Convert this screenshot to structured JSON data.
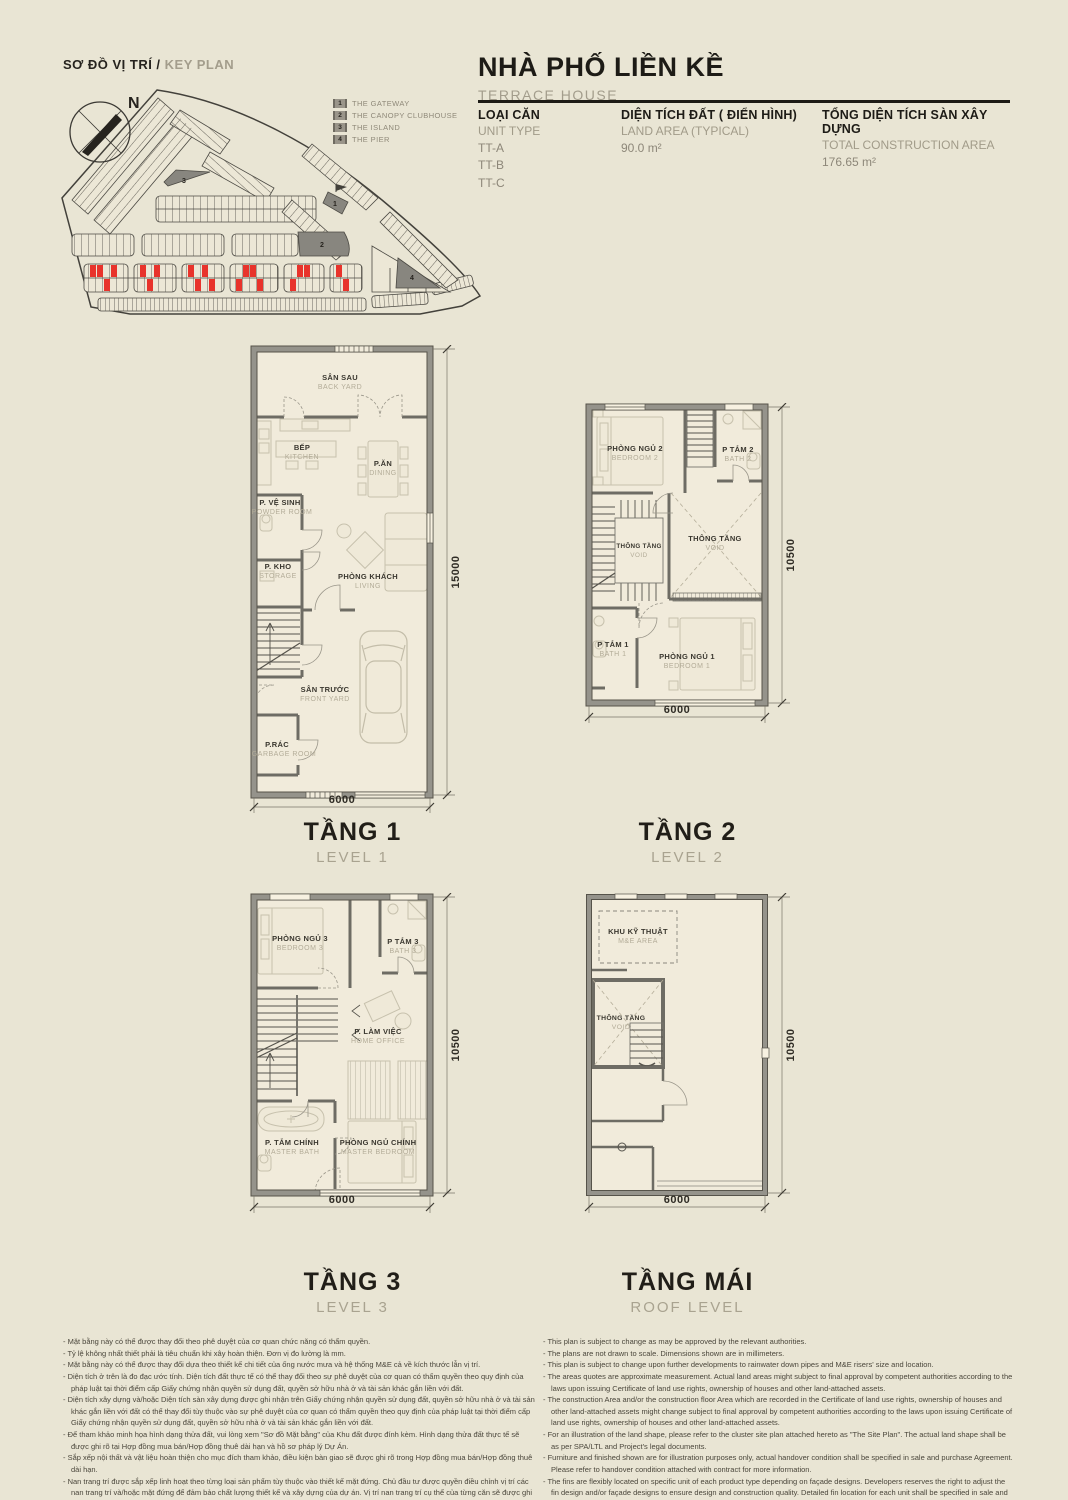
{
  "key_plan": {
    "title_vn": "SƠ ĐỒ VỊ TRÍ /",
    "title_en": " KEY PLAN",
    "north_label": "N",
    "legend": [
      {
        "num": "1",
        "label": "THE GATEWAY"
      },
      {
        "num": "2",
        "label": "THE CANOPY CLUBHOUSE"
      },
      {
        "num": "3",
        "label": "THE ISLAND"
      },
      {
        "num": "4",
        "label": "THE PIER"
      }
    ]
  },
  "header": {
    "title_vn": "NHÀ PHỐ LIỀN KỀ",
    "title_en": "TERRACE HOUSE",
    "unit_type": {
      "label_vn": "LOẠI CĂN",
      "label_en": "UNIT TYPE",
      "values": [
        "TT-A",
        "TT-B",
        "TT-C"
      ]
    },
    "land_area": {
      "label_vn": "DIỆN TÍCH ĐẤT ( ĐIỂN HÌNH)",
      "label_en": "LAND AREA (TYPICAL)",
      "value": "90.0 m²"
    },
    "construction_area": {
      "label_vn": "TỔNG DIỆN TÍCH SÀN XÂY DỰNG",
      "label_en": "TOTAL CONSTRUCTION AREA",
      "value": "176.65 m²"
    }
  },
  "plans": {
    "level1": {
      "title_vn": "TẦNG 1",
      "title_en": "LEVEL 1",
      "dim_width": "6000",
      "dim_height": "15000",
      "rooms": {
        "backyard_vn": "SÂN SAU",
        "backyard_en": "BACK YARD",
        "kitchen_vn": "BẾP",
        "kitchen_en": "KITCHEN",
        "dining_vn": "P.ĂN",
        "dining_en": "DINING",
        "powder_vn": "P. VỆ SINH",
        "powder_en": "POWDER ROOM",
        "storage_vn": "P. KHO",
        "storage_en": "STORAGE",
        "living_vn": "PHÒNG KHÁCH",
        "living_en": "LIVING",
        "frontyard_vn": "SÂN TRƯỚC",
        "frontyard_en": "FRONT YARD",
        "garbage_vn": "P.RÁC",
        "garbage_en": "GARBAGE ROOM"
      }
    },
    "level2": {
      "title_vn": "TẦNG 2",
      "title_en": "LEVEL 2",
      "dim_width": "6000",
      "dim_height": "10500",
      "rooms": {
        "bedroom2_vn": "PHÒNG NGỦ 2",
        "bedroom2_en": "BEDROOM 2",
        "bath2_vn": "P TẮM 2",
        "bath2_en": "BATH 2",
        "voidstair_vn": "THÔNG TẦNG",
        "voidstair_en": "VOID",
        "void_vn": "THÔNG TẦNG",
        "void_en": "VOID",
        "bath1_vn": "P TẮM 1",
        "bath1_en": "BATH 1",
        "bedroom1_vn": "PHÒNG NGỦ 1",
        "bedroom1_en": "BEDROOM 1"
      }
    },
    "level3": {
      "title_vn": "TẦNG 3",
      "title_en": "LEVEL 3",
      "dim_width": "6000",
      "dim_height": "10500",
      "rooms": {
        "bedroom3_vn": "PHÒNG NGỦ 3",
        "bedroom3_en": "BEDROOM 3",
        "bath3_vn": "P TẮM 3",
        "bath3_en": "BATH 3",
        "office_vn": "P. LÀM VIỆC",
        "office_en": "HOME OFFICE",
        "masterbath_vn": "P. TẮM CHÍNH",
        "masterbath_en": "MASTER BATH",
        "masterbed_vn": "PHÒNG NGỦ CHÍNH",
        "masterbed_en": "MASTER BEDROOM"
      }
    },
    "roof": {
      "title_vn": "TẦNG MÁI",
      "title_en": "ROOF LEVEL",
      "dim_width": "6000",
      "dim_height": "10500",
      "rooms": {
        "me_vn": "KHU KỸ THUẬT",
        "me_en": "M&E AREA",
        "void_vn": "THÔNG TẦNG",
        "void_en": "VOID"
      }
    }
  },
  "disclaimer": {
    "vn": [
      "- Mặt bằng này có thể được thay đổi theo phê duyệt của cơ quan chức năng có thẩm quyền.",
      "- Tỷ lệ không nhất thiết phải là tiêu chuẩn khi xây hoàn thiện. Đơn vị đo lường là mm.",
      "- Mặt bằng này có thể được thay đổi dựa theo thiết kế chi tiết của ống nước mưa và hệ thống M&E cả về kích thước lẫn vị trí.",
      "- Diện tích ở trên là đo đạc ước tính. Diện tích đất thực tế có thể thay đổi theo sự phê duyệt của cơ quan có thẩm quyền theo quy định của pháp luật tại thời điểm cấp Giấy chứng nhận quyền sử dụng đất, quyền sở hữu nhà ở và tài sản khác gắn liền với đất.",
      "- Diện tích xây dựng và/hoặc Diện tích sàn xây dựng được ghi nhận trên Giấy chứng nhận quyền sử dụng đất, quyền sở hữu nhà ở và tài sản khác gắn liền với đất có thể thay đổi tùy thuộc vào sự phê duyệt của cơ quan có thẩm quyền theo quy định của pháp luật tại thời điểm cấp Giấy chứng nhận quyền sử dụng đất, quyền sở hữu nhà ở và tài sản khác gắn liền với đất.",
      "- Để tham khảo minh họa hình dạng thửa đất, vui lòng xem \"Sơ đồ Mặt bằng\" của Khu đất được đính kèm. Hình dạng thửa đất thực tế sẽ được ghi rõ tại Hợp đồng mua bán/Hợp đồng thuê dài hạn và hồ sơ pháp lý Dự Án.",
      "- Sắp xếp nội thất và vật liệu hoàn thiện cho mục đích tham khảo, điều kiện bàn giao sẽ được ghi rõ trong Hợp đồng mua bán/Hợp đồng thuê dài hạn.",
      "- Nan trang trí được sắp xếp linh hoạt theo từng loại sản phẩm tùy thuộc vào thiết kế mặt đứng. Chủ đầu tư được quyền điều chỉnh vị trí các nan trang trí và/hoặc mặt đứng để đảm bảo chất lượng thiết kế và xây dựng của dự án. Vị trí nan trang trí cụ thể của từng căn sẽ được ghi rõ trong Hợp đồng mua bán/Hợp đồng thuê dài hạn. Thiết kế mặt đứng không được thay đổi trong quá trình sử dụng.",
      "- Tên nhà, số nhà, ký hiệu nhà và thông tin khác của nhà ở được thể hiện chỉ nhằm mục đích truyền thông. Thông tin chính thức của Nhà ở sẽ được ghi rõ tại Hợp đồng mua bán/Hợp đồng thuê dài hạn và hồ sơ pháp lý Dự Án."
    ],
    "en": [
      "- This plan is subject to change as may be approved by the relevant authorities.",
      "- The plans are not drawn to scale. Dimensions shown are in millimeters.",
      "- This plan is subject to change upon further developments to rainwater down pipes and M&E risers' size and location.",
      "- The areas quotes are approximate measurement. Actual land areas might subject to final approval by competent authorities according to the laws upon issuing Certificate of land use rights, ownership of houses and other land-attached assets.",
      "- The construction Area and/or the construction floor Area which are recorded in the Certificate of land use rights, ownership of houses and other land-attached assets might change subject to final approval by competent authorities according to the laws upon issuing Certificate of land use rights, ownership of houses and other land-attached assets.",
      "- For an illustration of the land shape, please refer to the cluster site plan attached hereto as \"The Site Plan\". The actual land shape shall be as per SPA/LTL and Project's legal documents.",
      "- Furniture and finished shown are for illustration purposes only, actual handover condition shall be specified in sale and purchase Agreement. Please refer to handover condition attached with contract for more information.",
      "- The fins are flexibly located on specific unit of each product type depending on façade designs. Developers reserves the right to adjust the fin design and/or façade designs to ensure design and construction quality. Detailed fin location for each unit shall be specified in sale and purchase Agreement. The façade design shall not be changed during use.",
      "- Unit name, unit number, unit code and other information of unit shown are for marketing purposes only. The official information of unit shall be as per SPA/LTL and Project's legal documents."
    ]
  }
}
